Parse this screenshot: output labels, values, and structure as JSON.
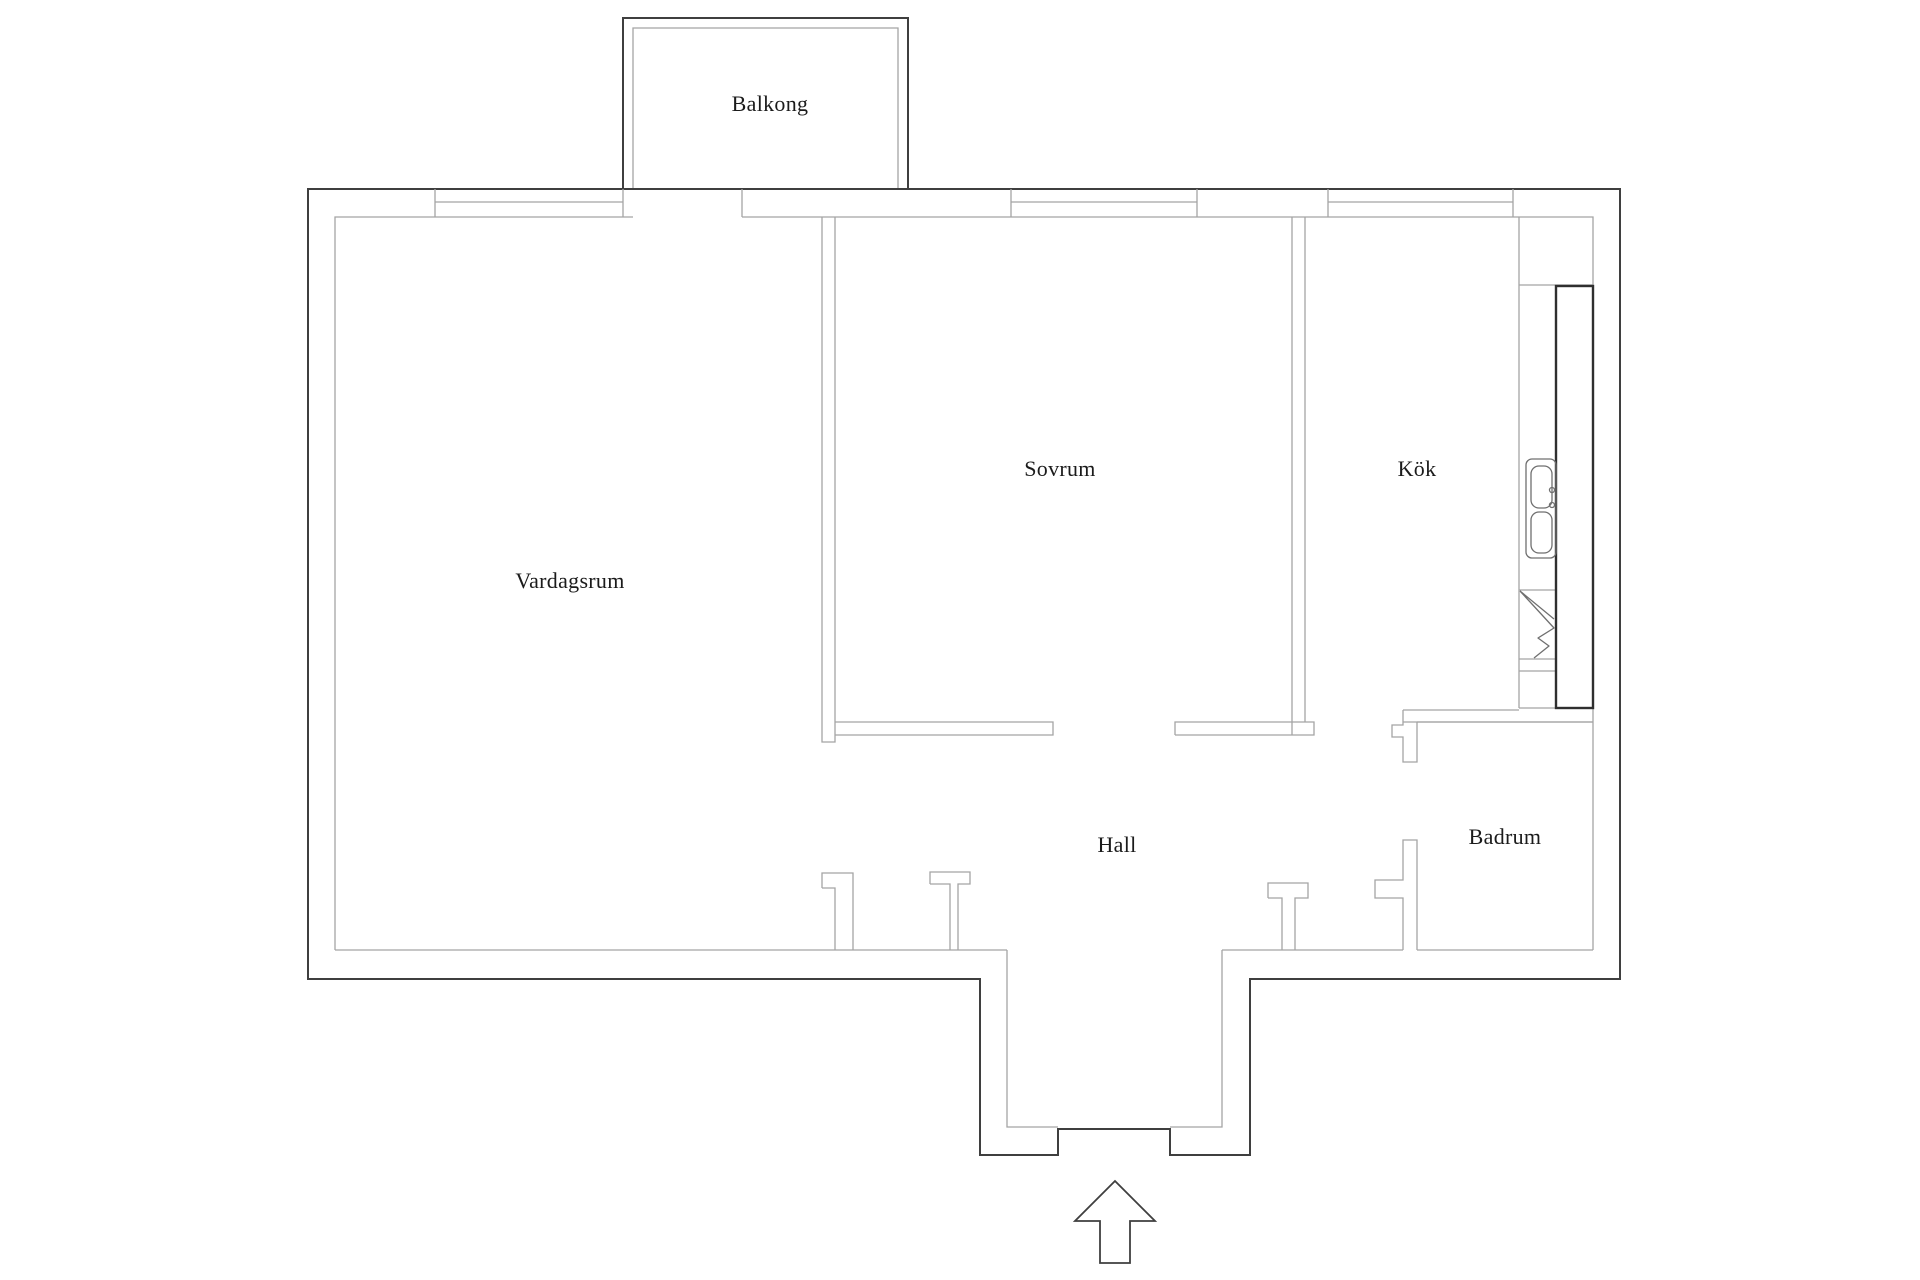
{
  "plan": {
    "type": "apartment-floor-plan",
    "rooms": [
      {
        "id": "balkong",
        "label": "Balkong"
      },
      {
        "id": "vardagsrum",
        "label": "Vardagsrum"
      },
      {
        "id": "sovrum",
        "label": "Sovrum"
      },
      {
        "id": "kok",
        "label": "Kök"
      },
      {
        "id": "hall",
        "label": "Hall"
      },
      {
        "id": "badrum",
        "label": "Badrum"
      }
    ],
    "fixtures": [
      {
        "id": "kitchen-counter",
        "description": "worktop run along right kitchen wall"
      },
      {
        "id": "kitchen-sink",
        "description": "double-basin sink"
      },
      {
        "id": "kitchen-appliance",
        "description": "appliance marked with diagonal glyph"
      }
    ],
    "icons": [
      {
        "id": "entrance-arrow-icon",
        "meaning": "entrance direction, pointing up into apartment"
      }
    ],
    "colors": {
      "background": "#ffffff",
      "outer_wall": "#3f3f3f",
      "inner_wall": "#a4a4a4",
      "counter": "#2f2f2f",
      "text": "#1b1b1b"
    }
  }
}
